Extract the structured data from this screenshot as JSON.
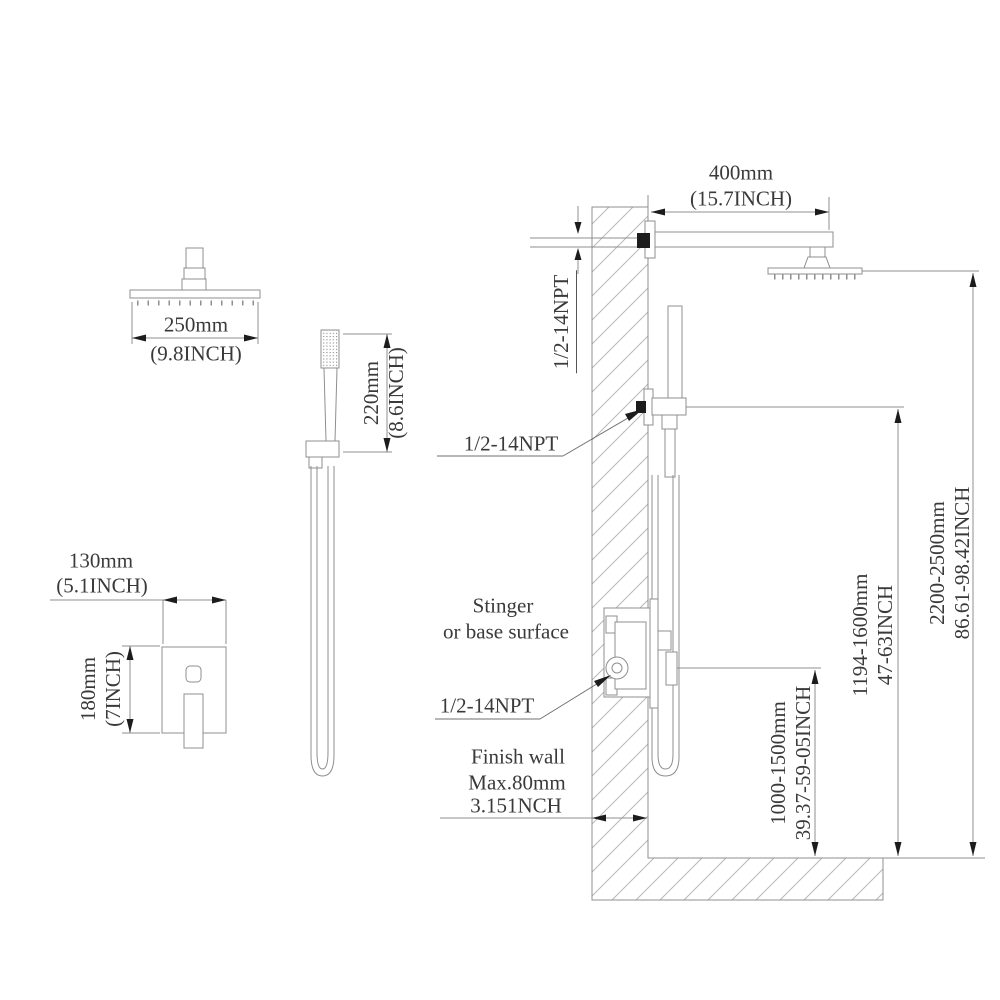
{
  "colors": {
    "line": "#8f8f8f",
    "text": "#3a3a3a",
    "fitting_black": "#1c1c1c",
    "background": "#ffffff"
  },
  "overhead_shower": {
    "width_mm": "250mm",
    "width_inch": "(9.8INCH)"
  },
  "hand_shower": {
    "height_mm": "220mm",
    "height_inch": "(8.6INCH)"
  },
  "valve_trim": {
    "width_mm": "130mm",
    "width_inch": "(5.1INCH)",
    "height_mm": "180mm",
    "height_inch": "(7INCH)"
  },
  "installation": {
    "arm_length_mm": "400mm",
    "arm_length_inch": "(15.7INCH)",
    "npt_arm": "1/2-14NPT",
    "npt_hand": "1/2-14NPT",
    "npt_valve": "1/2-14NPT",
    "surface_label_line1": "Stinger",
    "surface_label_line2": "or base surface",
    "finish_wall_line1": "Finish wall",
    "finish_wall_line2": "Max.80mm",
    "finish_wall_line3": "3.151NCH",
    "valve_height_mm": "1000-1500mm",
    "valve_height_inch": "39.37-59-05INCH",
    "bar_height_mm": "1194-1600mm",
    "bar_height_inch": "47-63INCH",
    "head_height_mm": "2200-2500mm",
    "head_height_inch": "86.61-98.42INCH"
  }
}
